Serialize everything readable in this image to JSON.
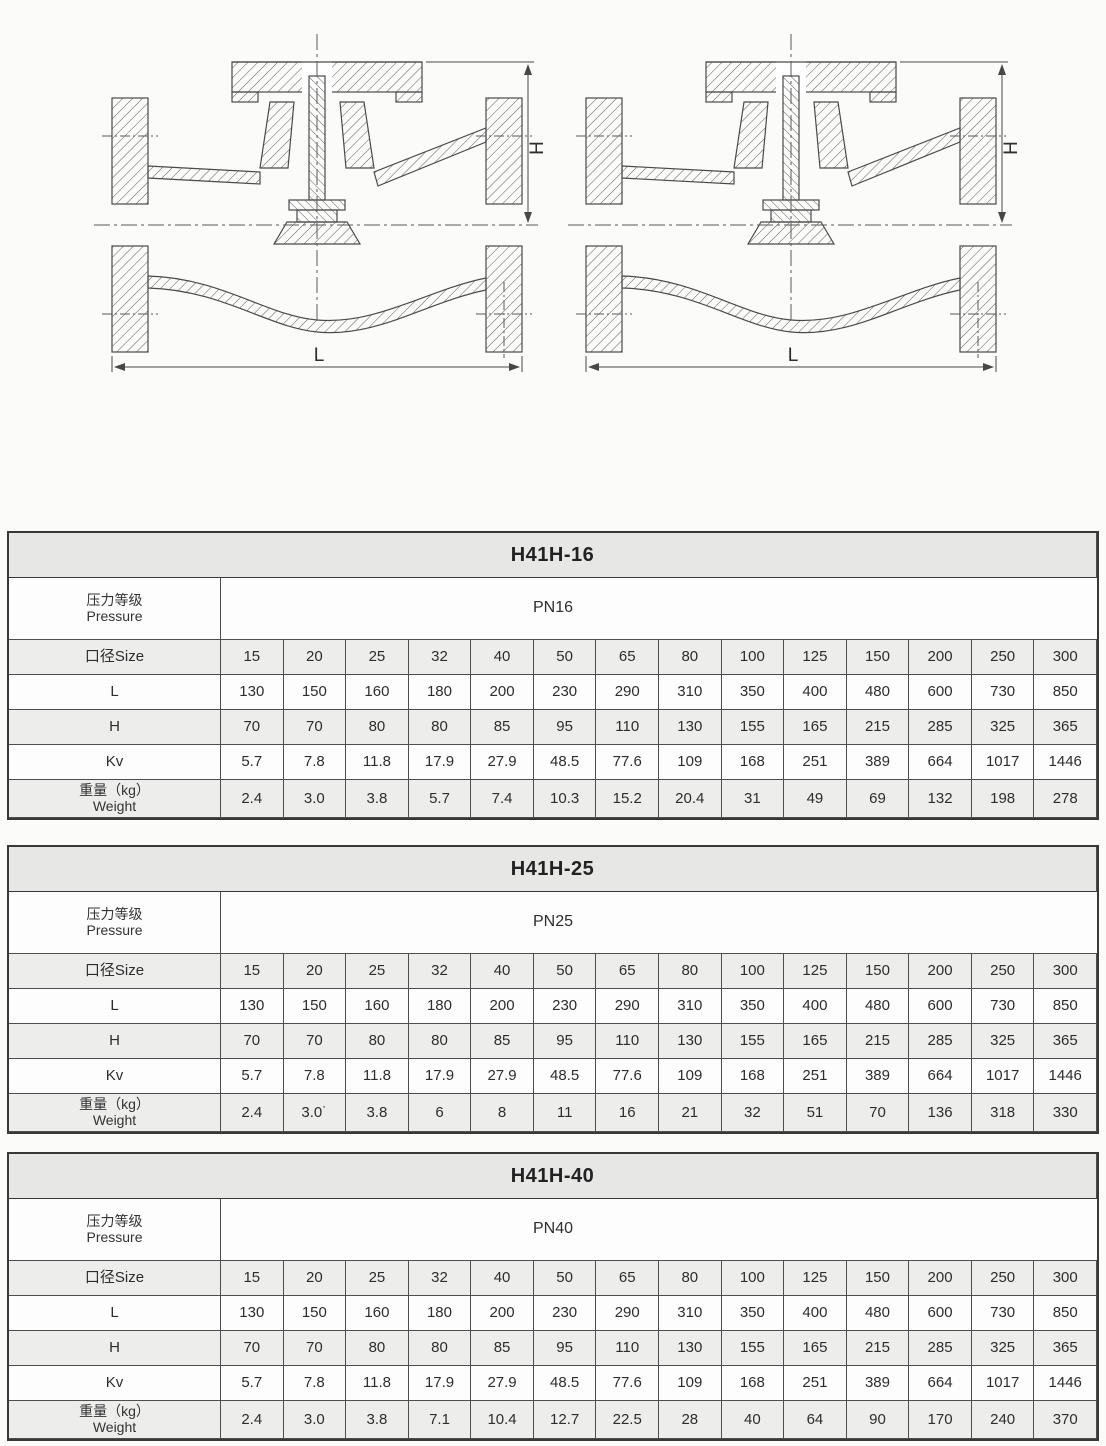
{
  "drawings": {
    "description": "lift check valve cross-section",
    "dim_height_label": "H",
    "dim_length_label": "L"
  },
  "tables": [
    {
      "title": "H41H-16",
      "pressure_label_zh": "压力等级",
      "pressure_label_en": "Pressure",
      "pressure_value": "PN16",
      "size_label": "口径Size",
      "l_label": "L",
      "h_label": "H",
      "kv_label": "Kv",
      "weight_label_zh": "重量（kg）",
      "weight_label_en": "Weight",
      "sizes": [
        "15",
        "20",
        "25",
        "32",
        "40",
        "50",
        "65",
        "80",
        "100",
        "125",
        "150",
        "200",
        "250",
        "300"
      ],
      "l_values": [
        "130",
        "150",
        "160",
        "180",
        "200",
        "230",
        "290",
        "310",
        "350",
        "400",
        "480",
        "600",
        "730",
        "850"
      ],
      "h_values": [
        "70",
        "70",
        "80",
        "80",
        "85",
        "95",
        "110",
        "130",
        "155",
        "165",
        "215",
        "285",
        "325",
        "365"
      ],
      "kv_values": [
        "5.7",
        "7.8",
        "11.8",
        "17.9",
        "27.9",
        "48.5",
        "77.6",
        "109",
        "168",
        "251",
        "389",
        "664",
        "1017",
        "1446"
      ],
      "weight_values": [
        "2.4",
        "3.0",
        "3.8",
        "5.7",
        "7.4",
        "10.3",
        "15.2",
        "20.4",
        "31",
        "49",
        "69",
        "132",
        "198",
        "278"
      ]
    },
    {
      "title": "H41H-25",
      "pressure_label_zh": "压力等级",
      "pressure_label_en": "Pressure",
      "pressure_value": "PN25",
      "size_label": "口径Size",
      "l_label": "L",
      "h_label": "H",
      "kv_label": "Kv",
      "weight_label_zh": "重量（kg）",
      "weight_label_en": "Weight",
      "sizes": [
        "15",
        "20",
        "25",
        "32",
        "40",
        "50",
        "65",
        "80",
        "100",
        "125",
        "150",
        "200",
        "250",
        "300"
      ],
      "l_values": [
        "130",
        "150",
        "160",
        "180",
        "200",
        "230",
        "290",
        "310",
        "350",
        "400",
        "480",
        "600",
        "730",
        "850"
      ],
      "h_values": [
        "70",
        "70",
        "80",
        "80",
        "85",
        "95",
        "110",
        "130",
        "155",
        "165",
        "215",
        "285",
        "325",
        "365"
      ],
      "kv_values": [
        "5.7",
        "7.8",
        "11.8",
        "17.9",
        "27.9",
        "48.5",
        "77.6",
        "109",
        "168",
        "251",
        "389",
        "664",
        "1017",
        "1446"
      ],
      "weight_values": [
        "2.4",
        "3.0˙",
        "3.8",
        "6",
        "8",
        "11",
        "16",
        "21",
        "32",
        "51",
        "70",
        "136",
        "318",
        "330"
      ]
    },
    {
      "title": "H41H-40",
      "pressure_label_zh": "压力等级",
      "pressure_label_en": "Pressure",
      "pressure_value": "PN40",
      "size_label": "口径Size",
      "l_label": "L",
      "h_label": "H",
      "kv_label": "Kv",
      "weight_label_zh": "重量（kg）",
      "weight_label_en": "Weight",
      "sizes": [
        "15",
        "20",
        "25",
        "32",
        "40",
        "50",
        "65",
        "80",
        "100",
        "125",
        "150",
        "200",
        "250",
        "300"
      ],
      "l_values": [
        "130",
        "150",
        "160",
        "180",
        "200",
        "230",
        "290",
        "310",
        "350",
        "400",
        "480",
        "600",
        "730",
        "850"
      ],
      "h_values": [
        "70",
        "70",
        "80",
        "80",
        "85",
        "95",
        "110",
        "130",
        "155",
        "165",
        "215",
        "285",
        "325",
        "365"
      ],
      "kv_values": [
        "5.7",
        "7.8",
        "11.8",
        "17.9",
        "27.9",
        "48.5",
        "77.6",
        "109",
        "168",
        "251",
        "389",
        "664",
        "1017",
        "1446"
      ],
      "weight_values": [
        "2.4",
        "3.0",
        "3.8",
        "7.1",
        "10.4",
        "12.7",
        "22.5",
        "28",
        "40",
        "64",
        "90",
        "170",
        "240",
        "370"
      ]
    }
  ]
}
